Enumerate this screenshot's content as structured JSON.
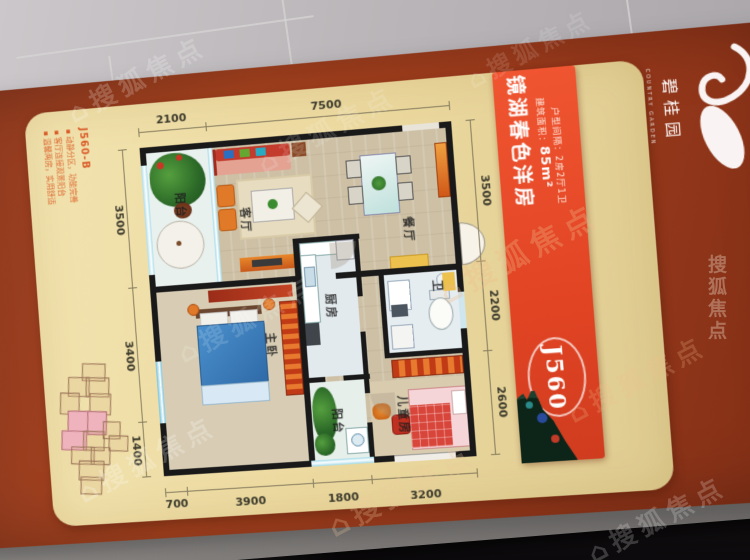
{
  "watermark": {
    "text": "搜狐焦点",
    "house_icon": "⌂"
  },
  "brand": {
    "name": "碧桂园",
    "name_en": "COUNTRY GARDEN"
  },
  "banner": {
    "title": "镜湖春色洋房",
    "area_label": "建筑面积：",
    "area_value": "85m²",
    "layout_label": "户型间隔：",
    "layout_value": "2房2厅1卫",
    "unit_code": "J560"
  },
  "info": {
    "heading": "J560-B",
    "bullets": [
      "动静分区，功能完善",
      "客厅连接观景阳台",
      "温馨两房，实用舒适"
    ]
  },
  "plan": {
    "rooms": {
      "balcony_top": "阳台",
      "living": "客厅",
      "dining": "餐厅",
      "master": "主卧",
      "kitchen": "厨房",
      "bath": "卫",
      "kids": "儿童房",
      "balcony_bottom": "阳台"
    },
    "dims": {
      "top": [
        "2100",
        "7500"
      ],
      "left": [
        "3500",
        "3400",
        "1400"
      ],
      "right": [
        "3500",
        "2200",
        "2600"
      ],
      "bottom": [
        "700",
        "3900",
        "1800",
        "3200"
      ]
    }
  },
  "colors": {
    "board": "#9c3c20",
    "card": "#ecd9a0",
    "banner": "#e6492a",
    "accent": "#d96a28"
  }
}
